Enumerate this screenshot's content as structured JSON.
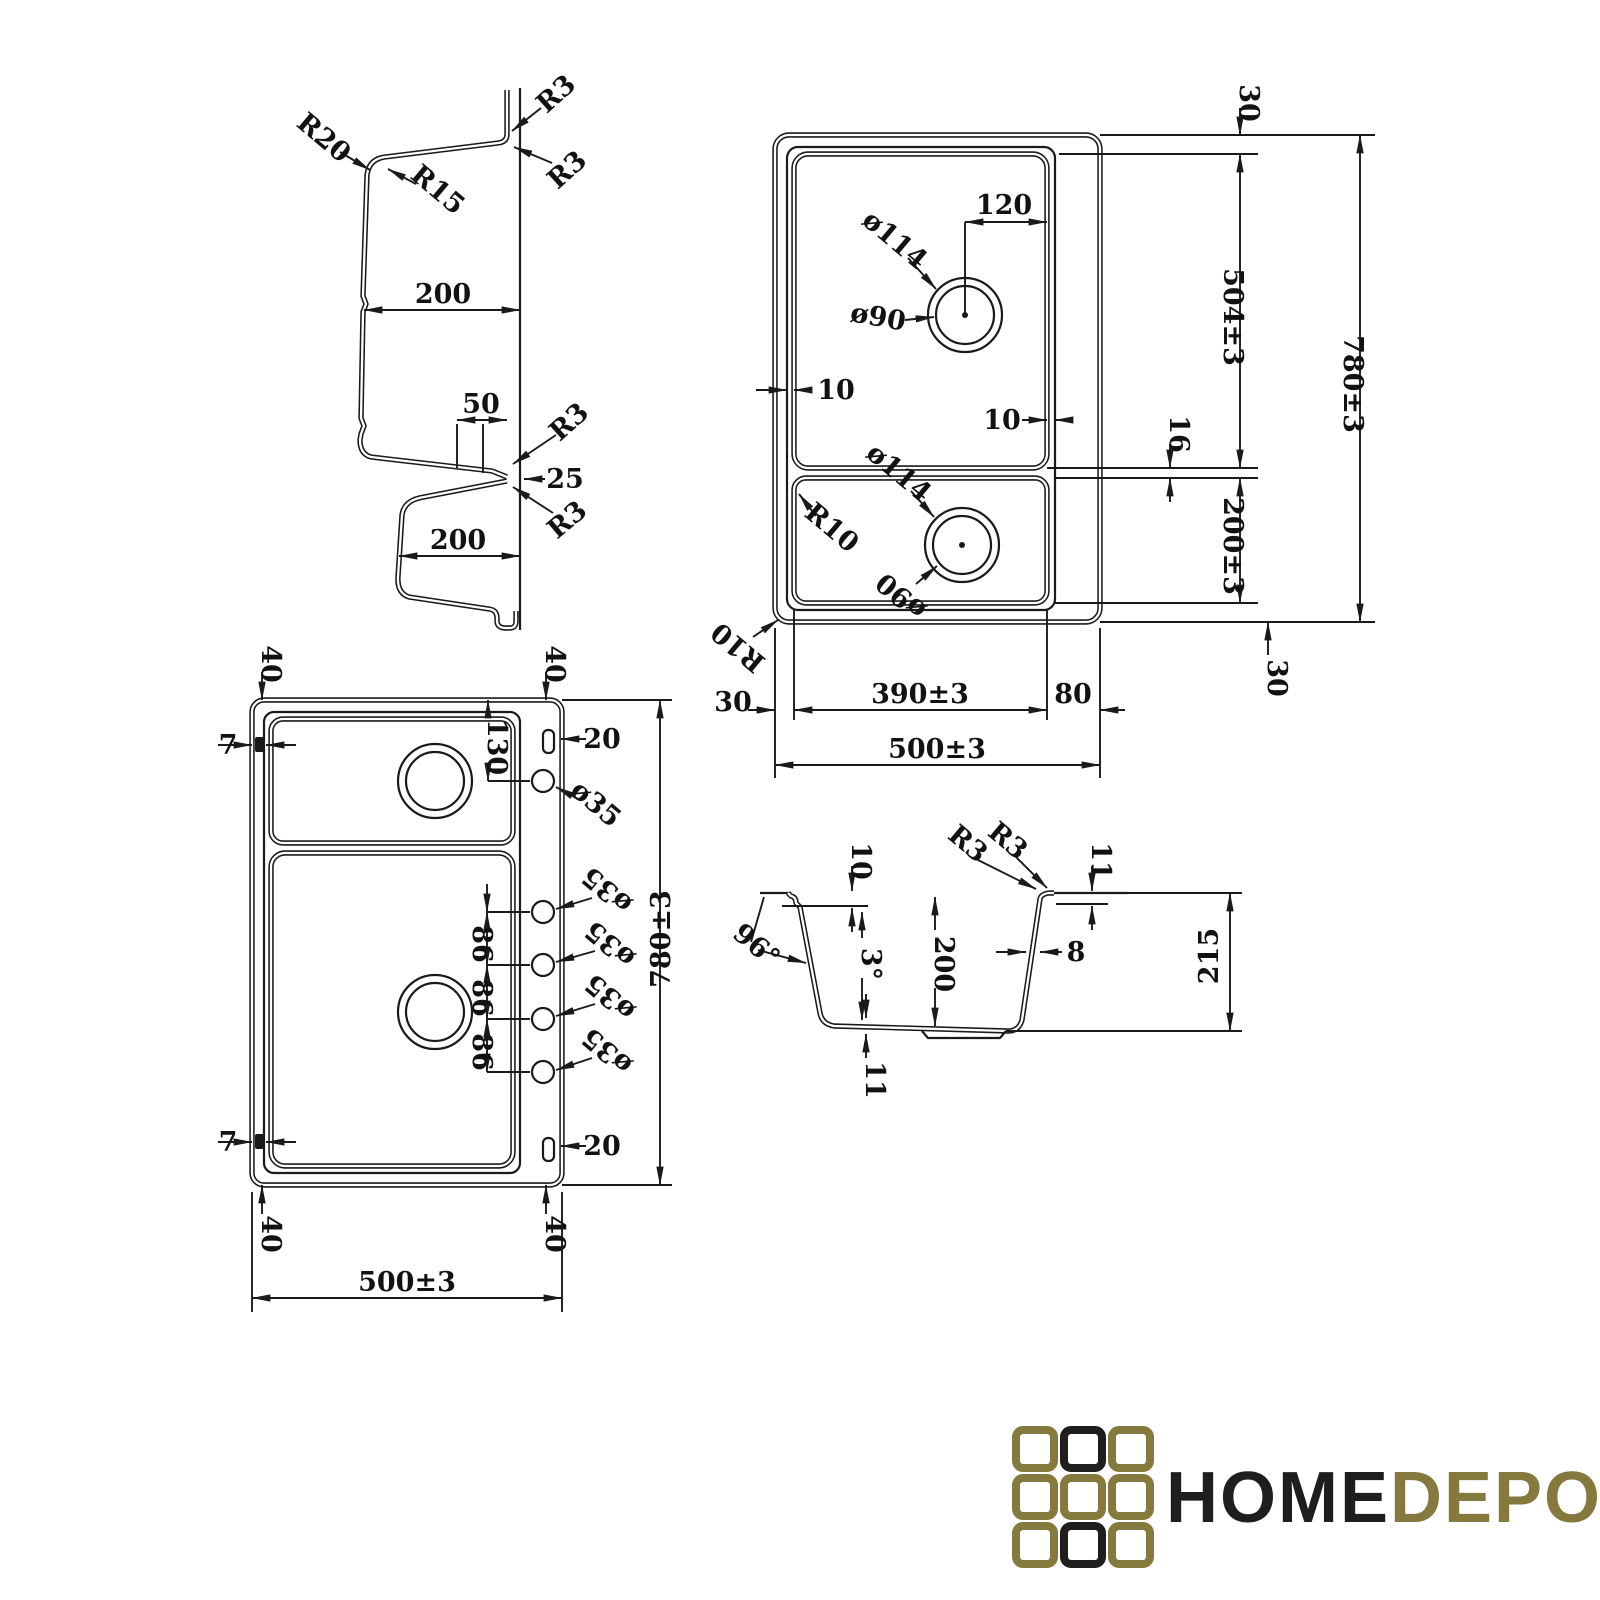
{
  "drawing": {
    "background": "#ffffff",
    "line_color": "#1a1a1a"
  },
  "profile_view": {
    "r20": "R20",
    "r15": "R15",
    "r3_lip_top": "R3",
    "r3_lip_side": "R3",
    "bowl1_width": "200",
    "divider_width": "50",
    "divider_offset": "25",
    "r3_divider_upper": "R3",
    "r3_divider_lower": "R3",
    "bowl2_width": "200"
  },
  "plan_view": {
    "drain1_outer_dia": "ø114",
    "drain1_inner_dia": "ø90",
    "drain1_offset": "120",
    "top_margin": "30",
    "bowl1_length": "504±3",
    "overall_length": "780±3",
    "rim_gap_left": "10",
    "rim_gap_right": "10",
    "divider_gap": "16",
    "drain2_outer_dia": "ø114",
    "drain2_inner_dia": "ø90",
    "bowl_corner_radius": "R10",
    "outer_corner_radius": "R10",
    "bowl2_length": "200±3",
    "bottom_margin": "30",
    "left_margin": "30",
    "bowl_width": "390±3",
    "right_margin": "80",
    "overall_width": "500±3"
  },
  "holes_view": {
    "corner_offset_tl": "40",
    "corner_offset_tr": "40",
    "corner_offset_bl": "40",
    "corner_offset_br": "40",
    "clip_top": "7",
    "clip_bottom": "7",
    "slot_top": "20",
    "slot_bottom": "20",
    "first_hole_offset": "130",
    "hole_dias": [
      "ø35",
      "ø35",
      "ø35",
      "ø35",
      "ø35"
    ],
    "hole_spacings": [
      "86",
      "86",
      "86"
    ],
    "overall_length": "780±3",
    "overall_width": "500±3"
  },
  "section_view": {
    "rim_drop": "10",
    "r3_outer": "R3",
    "r3_inner": "R3",
    "rim_height": "11",
    "wall_angle": "96°",
    "bottom_slope": "3°",
    "bowl_depth": "200",
    "wall_thickness": "8",
    "overall_depth": "215",
    "bottom_thickness": "11"
  },
  "logo": {
    "home": "HOME",
    "depo": "DEPO",
    "gold": "#86793d",
    "black": "#1e1e1e",
    "square_colors": [
      "#86793d",
      "#1e1e1e",
      "#86793d",
      "#86793d",
      "#86793d",
      "#86793d",
      "#86793d",
      "#1e1e1e",
      "#86793d"
    ]
  }
}
